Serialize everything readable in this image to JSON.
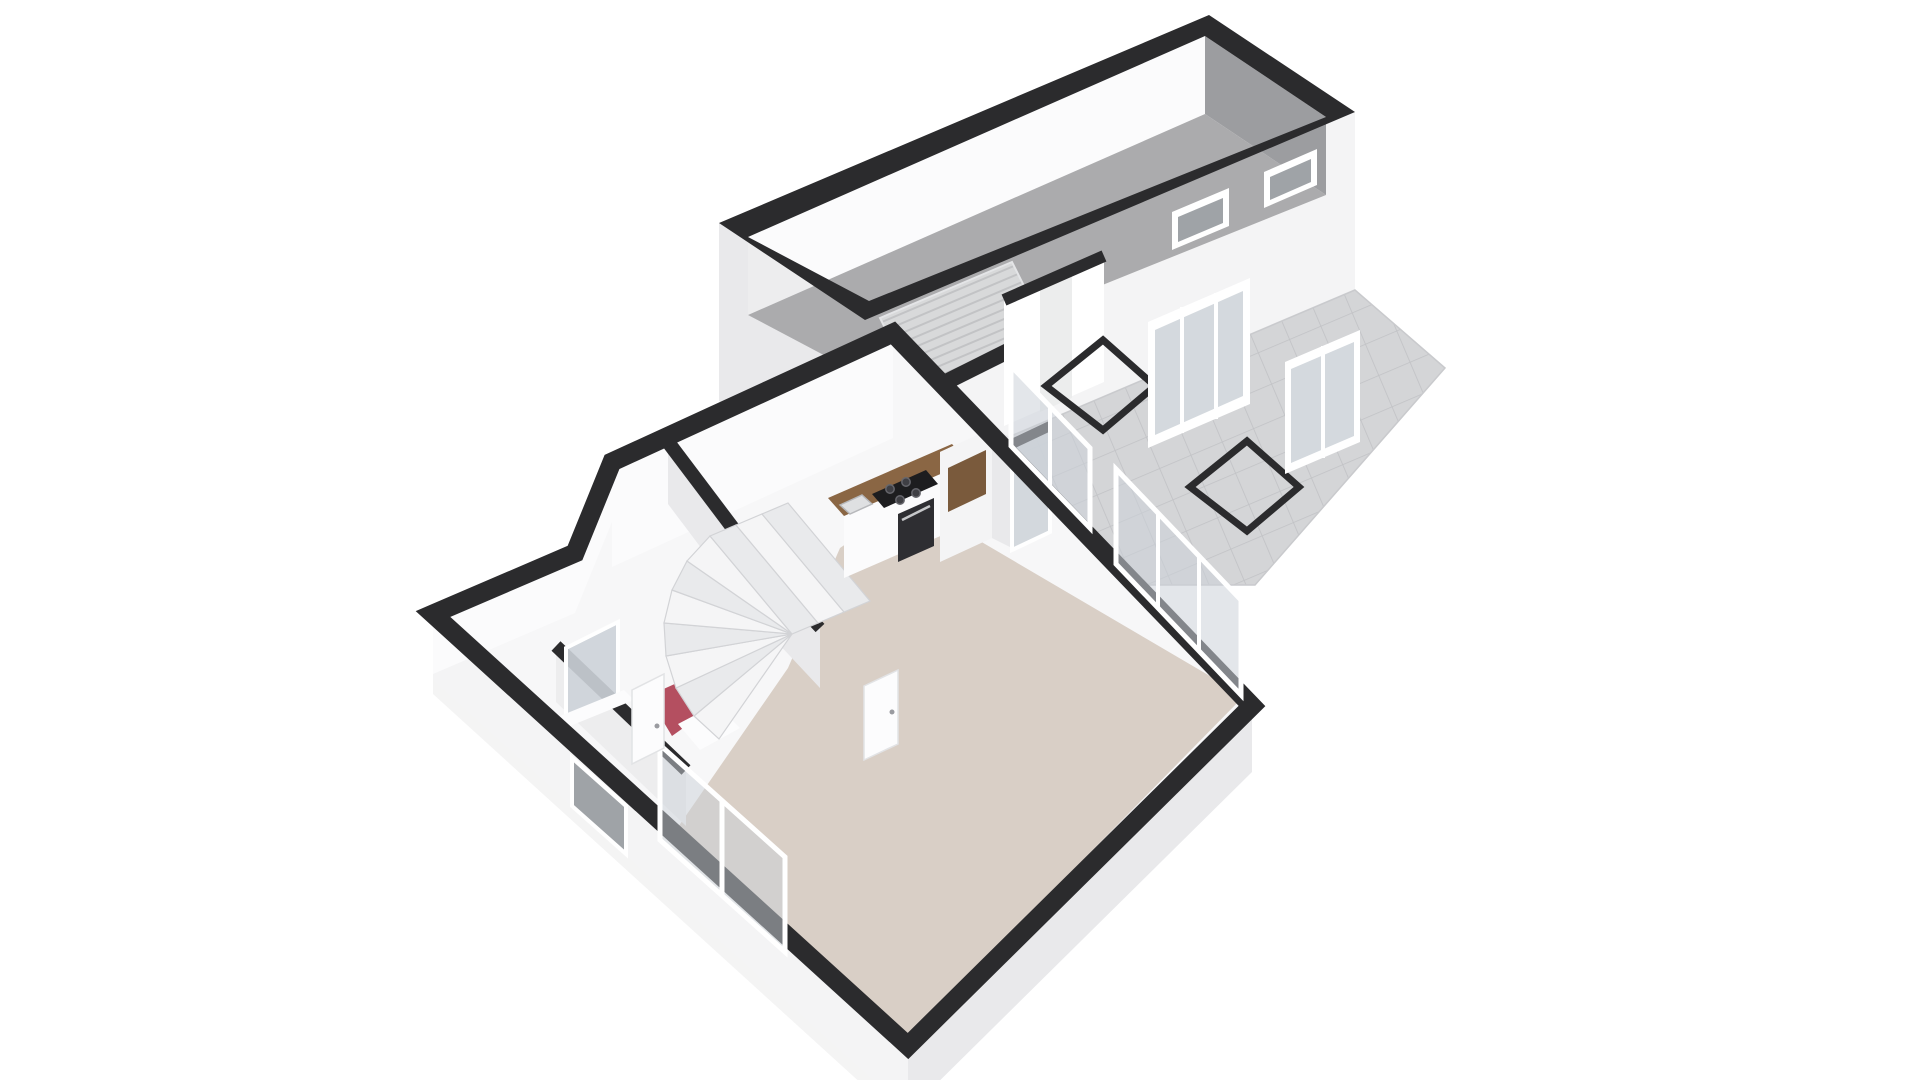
{
  "scene": {
    "description": "3D isometric floor plan, ground floor with garage, patio and living areas",
    "background": "#ffffff"
  },
  "colors": {
    "wallTop": "#2b2b2d",
    "wallFace": "#f4f4f5",
    "wallFaceShade": "#e9e9eb",
    "wallInnerLit": "#fbfbfc",
    "wallInnerShade": "#ededee",
    "garageFarWall": "#9c9da0",
    "garageFloor": "#ababad",
    "ribBase": "#d8d9da",
    "ribStripe": "#c2c3c5",
    "tileBase": "#d4d5d7",
    "tileLine": "#c1c2c5",
    "glass": "#ccd2d8",
    "glassDark": "#9fa3a7",
    "frameWhite": "#ffffff",
    "beige": "#d9cfc6",
    "red": "#b44f60",
    "mat": "#fcfcfd",
    "wood": "#8a6644",
    "nicheWood": "#7a5a3c",
    "cooktop": "#1d1d1f",
    "burner": "#3f3f44",
    "burnerRing": "#66666c",
    "oven": "#2e2e32",
    "steel": "#c6c7ca",
    "treads": "#f5f5f6",
    "treadsAlt": "#e9eaec",
    "treadEdge": "#d2d3d6",
    "interiorFloor": "#f7f7f8",
    "throughGap": "#eceded",
    "sinkFill": "#dfe0e2",
    "sinkEdge": "#b7b8bb",
    "doorEdge": "#e2e3e5",
    "handle": "#9a9ba0",
    "edgeLight": "#e4e5e7",
    "patioEdge": "#c9cacd"
  },
  "elements": [
    {
      "name": "garage",
      "kind": "room",
      "floor": "gray-concrete"
    },
    {
      "name": "garage-door-ribbed",
      "kind": "sectional-door"
    },
    {
      "name": "garage-window",
      "kind": "window",
      "count": 2
    },
    {
      "name": "patio",
      "kind": "outdoor-tiled-terrace"
    },
    {
      "name": "floor-frame-square",
      "kind": "open-floor-frame",
      "count": 2
    },
    {
      "name": "glass-wall",
      "kind": "glazing",
      "count": 2
    },
    {
      "name": "passage-doorway",
      "kind": "wall-opening"
    },
    {
      "name": "kitchen",
      "kind": "room",
      "features": [
        "wood-counter",
        "cooktop",
        "oven",
        "sink",
        "tall-cabinets",
        "glass-door"
      ]
    },
    {
      "name": "winder-staircase",
      "kind": "stairs"
    },
    {
      "name": "entry-hall",
      "kind": "room",
      "floor": "red"
    },
    {
      "name": "doormat",
      "kind": "mat"
    },
    {
      "name": "wc",
      "kind": "room",
      "features": [
        "window"
      ]
    },
    {
      "name": "living-dining",
      "kind": "room",
      "floor": "beige"
    },
    {
      "name": "front-window",
      "kind": "window"
    },
    {
      "name": "front-small-window",
      "kind": "window"
    },
    {
      "name": "front-door",
      "kind": "door"
    },
    {
      "name": "interior-door",
      "kind": "door"
    },
    {
      "name": "sliding-glass-door",
      "kind": "glazing"
    },
    {
      "name": "living-glass-wall",
      "kind": "glazing"
    }
  ]
}
